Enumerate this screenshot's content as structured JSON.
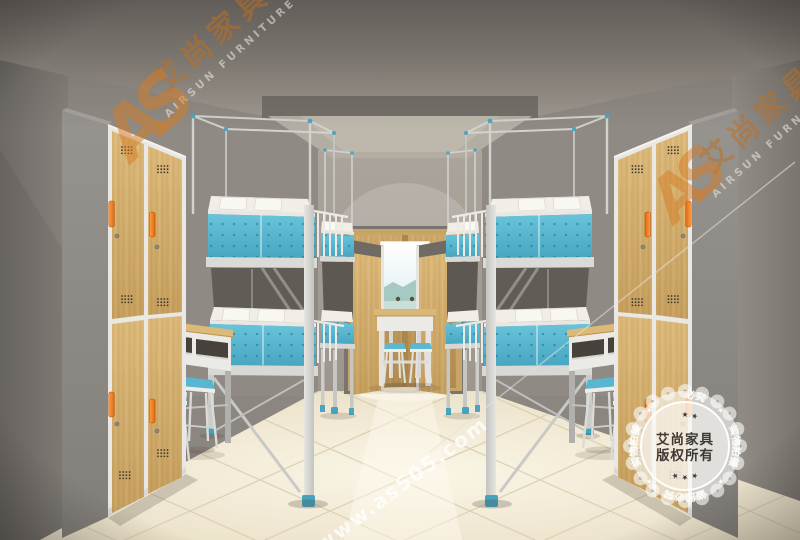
{
  "watermark": {
    "brand_cn": "艾尚家具",
    "brand_en": "AIRSUN FURNITURE",
    "monogram": "AS",
    "url": "www.as505.com"
  },
  "stamp": {
    "center_line1": "艾尚家具",
    "center_line2": "版权所有",
    "ring_top": "盗图必究",
    "ring_bottom": "盗图必究",
    "ring_left": "实物拍摄",
    "ring_right": "实物拍摄",
    "star": "★",
    "stars_row": "★ ★ ★"
  },
  "colors": {
    "bed_panel_teal": "#54b4ce",
    "locker_wood": "#d3ae6b",
    "handle_orange": "#f5821f",
    "floor_cream": "#f3ecd8",
    "wall_gray": "#8d8882",
    "watermark_orange": "#c46e1e",
    "stamp_white": "#faf9f6"
  }
}
